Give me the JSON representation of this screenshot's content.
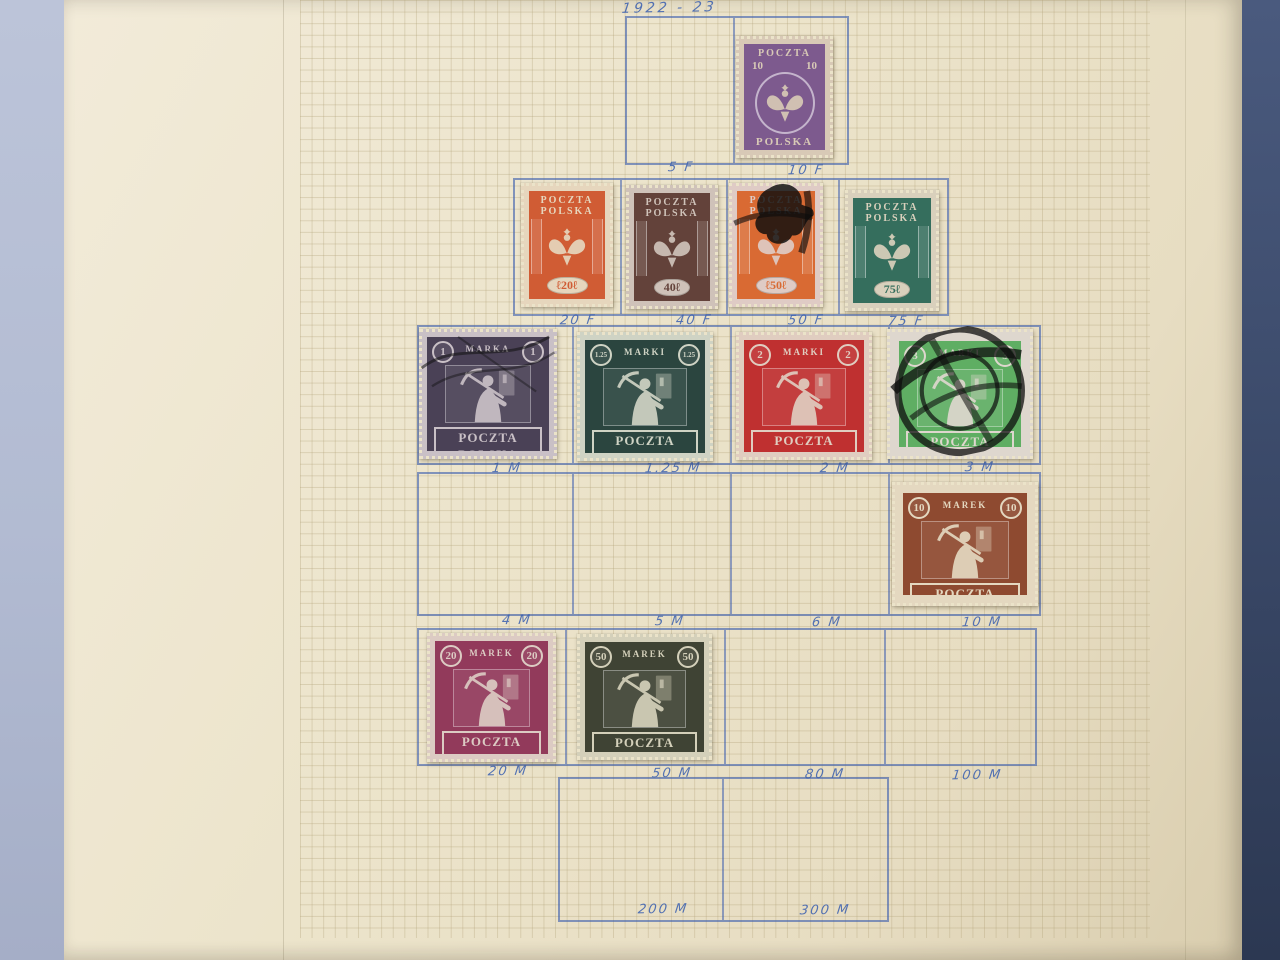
{
  "heading": "1922 - 23",
  "palette": {
    "background_left": "#b6bfd5",
    "background_right": "#3c4b6b",
    "album_page": "#ebe3ca",
    "grid_line": "#b0a076",
    "ink_blue": "#3f63b0"
  },
  "rows": [
    {
      "labels": [
        "5 F",
        "10 F"
      ]
    },
    {
      "labels": [
        "20 F",
        "40 F",
        "50 F",
        "75 F"
      ]
    },
    {
      "labels": [
        "1 M",
        "1.25 M",
        "2 M",
        "3 M"
      ]
    },
    {
      "labels": [
        "4 M",
        "5 M",
        "6 M",
        "10 M"
      ]
    },
    {
      "labels": [
        "20 M",
        "50 M",
        "80 M",
        "100 M"
      ]
    },
    {
      "labels": [
        "200 M",
        "300 M"
      ]
    }
  ],
  "stamps": [
    {
      "id": "10f",
      "design": "eagle-arms",
      "line1": "POCZTA",
      "line2": "POLSKA",
      "value": "10",
      "frame": "#7d5a8e",
      "paper": "#d8c9b6",
      "postmark": null
    },
    {
      "id": "20f",
      "design": "eagle-torches",
      "line1": "POCZTA",
      "line2": "POLSKA",
      "value": "ℓ20ℓ",
      "frame": "#d05c34",
      "paper": "#e6d6bd",
      "postmark": null
    },
    {
      "id": "40f",
      "design": "eagle-torches",
      "line1": "POCZTA",
      "line2": "POLSKA",
      "value": "40ℓ",
      "frame": "#63423a",
      "paper": "#cfc2b9",
      "postmark": null
    },
    {
      "id": "50f",
      "design": "eagle-torches",
      "line1": "POCZTA",
      "line2": "POLSKA",
      "value": "ℓ50ℓ",
      "frame": "#d96a33",
      "paper": "#dfcbc5",
      "postmark": "heavy-smudge"
    },
    {
      "id": "75f",
      "design": "eagle-torches",
      "line1": "POCZTA",
      "line2": "POLSKA",
      "value": "75ℓ",
      "frame": "#356e5d",
      "paper": "#d9d0bc",
      "postmark": null
    },
    {
      "id": "1m",
      "design": "miner",
      "word": "MARKA",
      "value": "1",
      "bottom": "POCZTA POLSKA",
      "frame": "#4a4156",
      "paper": "#c9c0c6",
      "postmark": "pen-lines"
    },
    {
      "id": "1.25m",
      "design": "miner",
      "word": "MARKI",
      "value": "1.25",
      "bottom": "POCZTA POLSKA",
      "frame": "#2b453f",
      "paper": "#cfd3c4",
      "postmark": null
    },
    {
      "id": "2m",
      "design": "miner",
      "word": "MARKI",
      "value": "2",
      "bottom": "POCZTA POLSKA",
      "frame": "#bf3030",
      "paper": "#e0cdc0",
      "postmark": null
    },
    {
      "id": "3m",
      "design": "miner",
      "word": "MARKI",
      "value": "3",
      "bottom": "POCZTA POLSKA",
      "frame": "#5fae63",
      "paper": "#ded7ce",
      "postmark": "circular-datestamp"
    },
    {
      "id": "10m",
      "design": "miner",
      "word": "MAREK",
      "value": "10",
      "bottom": "POCZTA POLSKA",
      "frame": "#8e4a30",
      "paper": "#e4d8c0",
      "postmark": null
    },
    {
      "id": "20m",
      "design": "miner",
      "word": "MAREK",
      "value": "20",
      "bottom": "POCZTA POLSKA",
      "frame": "#923a5b",
      "paper": "#dccbc3",
      "postmark": null
    },
    {
      "id": "50m",
      "design": "miner",
      "word": "MAREK",
      "value": "50",
      "bottom": "POCZTA POLSKA",
      "frame": "#3f4334",
      "paper": "#d4d0ba",
      "postmark": null
    }
  ]
}
